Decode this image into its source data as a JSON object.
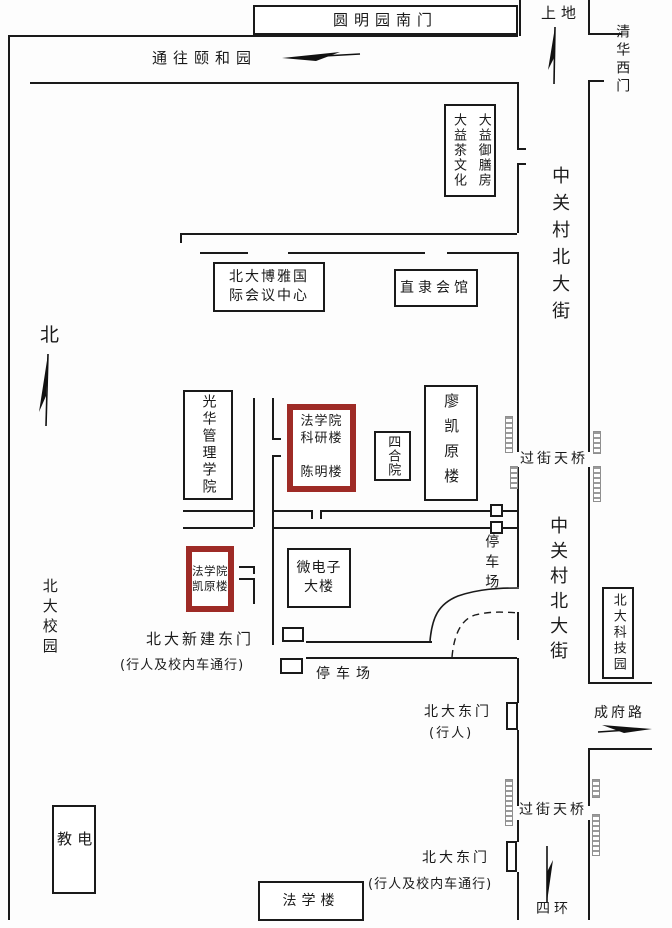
{
  "colors": {
    "line": "#1a1a1a",
    "highlight_red": "#9e2b26",
    "ladder_gray": "#9a9a9a",
    "background": "#fdfdfd"
  },
  "gates_top": {
    "yuanmingyuan": "圆明园南门",
    "to_yiheyuan": "通往颐和园",
    "shangdi": "上地",
    "qinghua_west": "清华西门"
  },
  "streets": {
    "zhongguancun_upper": "中关村北大街",
    "zhongguancun_lower": "中关村北大街",
    "chengfu": "成府路",
    "sihuan": "四环"
  },
  "compass": {
    "north": "北"
  },
  "campus": {
    "name": "北大校园"
  },
  "buildings": {
    "dayi": "大益御膳房\n大益茶文化",
    "boya": "北大博雅国\n际会议中心",
    "zhili": "直隶会馆",
    "guanghua": "光华管理学院",
    "law_research": "法学院\n科研楼\n\n陈明楼",
    "siheyuan": "四合院",
    "liaokaiyuan": "廖凯原楼",
    "law_kaiyuan": "法学院\n凯原楼",
    "microelectronics": "微电子\n大楼",
    "science_park": "北大科技园",
    "dianjiao": "电教",
    "law_building": "法学楼"
  },
  "landmarks": {
    "footbridge1": "过街天桥",
    "footbridge2": "过街天桥",
    "parking1": "停车场",
    "parking2": "停车场",
    "new_east_gate": "北大新建东门",
    "new_east_gate_note": "(行人及校内车通行)",
    "east_gate_ped": "北大东门",
    "east_gate_ped_note": "(行人)",
    "east_gate_south": "北大东门",
    "east_gate_south_note": "(行人及校内车通行)"
  }
}
